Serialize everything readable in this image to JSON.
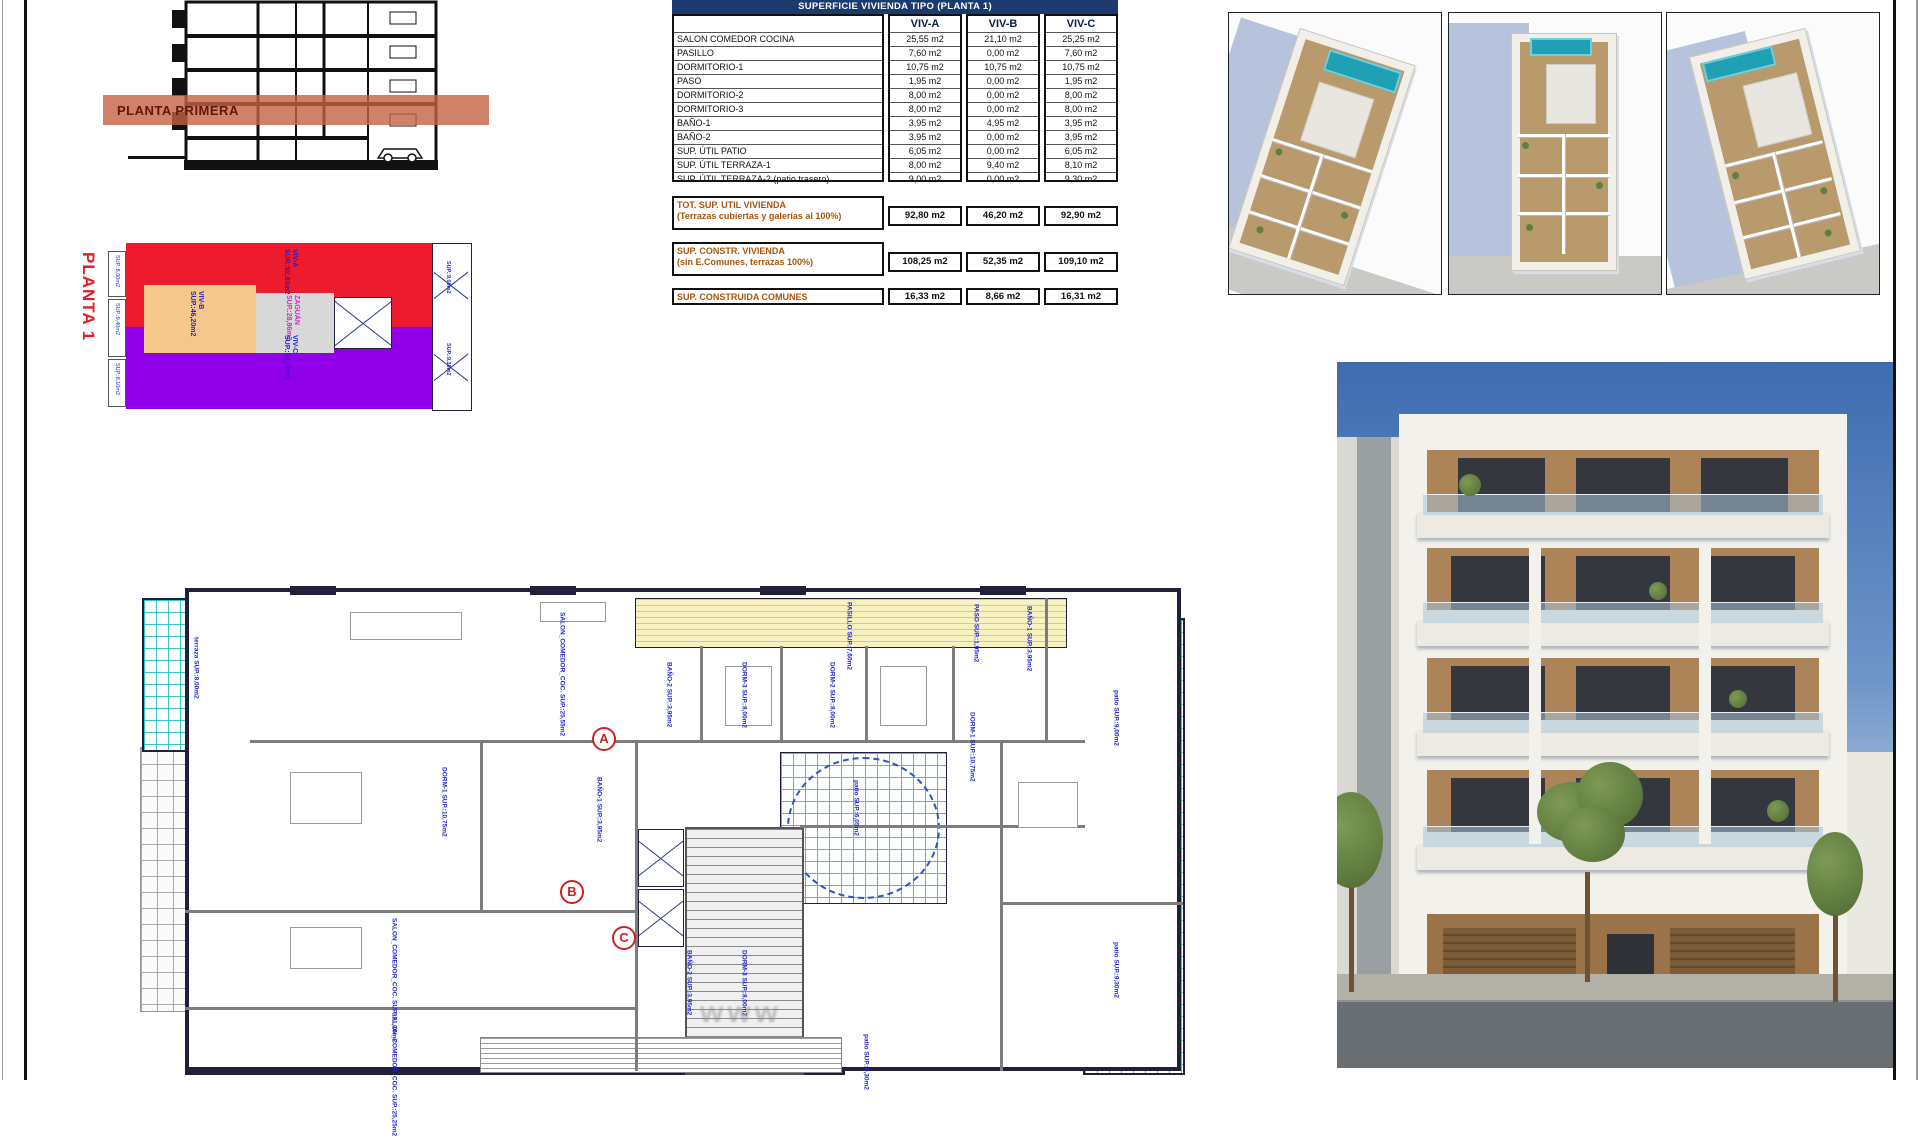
{
  "section_view": {
    "band_label": "PLANTA PRIMERA"
  },
  "key_plan": {
    "title": "PLANTA 1",
    "zones": {
      "viv_a": {
        "name": "VIV-A",
        "area": "SUP.:92,80m2",
        "color": "#ec1b2e"
      },
      "viv_b": {
        "name": "VIV-B",
        "area": "SUP.:46,20m2",
        "color": "#f6c78a"
      },
      "viv_c": {
        "name": "VIV-C",
        "area": "SUP.:92,90m2",
        "color": "#8f00e8"
      },
      "zaguan": {
        "name": "ZAGUÁN",
        "area": "SUP.:28,86m2",
        "color": "#d8d8d8"
      }
    },
    "edge_labels": [
      "SUP.:8,00m2",
      "SUP.:9,40m2",
      "SUP.:8,10m2",
      "SUP.:9,00m2",
      "SUP.:9,30m2"
    ]
  },
  "area_table": {
    "title": "SUPERFICIE VIVIENDA TIPO  (PLANTA 1)",
    "columns": [
      "VIV-A",
      "VIV-B",
      "VIV-C"
    ],
    "rows": [
      {
        "label": "SALON COMEDOR COCINA",
        "values": [
          "25,55 m2",
          "21,10 m2",
          "25,25 m2"
        ]
      },
      {
        "label": "PASILLO",
        "values": [
          "7,60 m2",
          "0,00 m2",
          "7,60 m2"
        ]
      },
      {
        "label": "DORMITORIO-1",
        "values": [
          "10,75 m2",
          "10,75 m2",
          "10,75 m2"
        ]
      },
      {
        "label": "PASO",
        "values": [
          "1,95 m2",
          "0,00 m2",
          "1,95 m2"
        ]
      },
      {
        "label": "DORMITORIO-2",
        "values": [
          "8,00 m2",
          "0,00 m2",
          "8,00 m2"
        ]
      },
      {
        "label": "DORMITORIO-3",
        "values": [
          "8,00 m2",
          "0,00 m2",
          "8,00 m2"
        ]
      },
      {
        "label": "BAÑO-1",
        "values": [
          "3,95 m2",
          "4,95 m2",
          "3,95 m2"
        ]
      },
      {
        "label": "BAÑO-2",
        "values": [
          "3,95 m2",
          "0,00 m2",
          "3,95 m2"
        ]
      },
      {
        "label": "SUP. ÚTIL PATIO",
        "values": [
          "6,05 m2",
          "0,00 m2",
          "6,05 m2"
        ]
      },
      {
        "label": "SUP. ÚTIL TERRAZA-1",
        "values": [
          "8,00 m2",
          "9,40 m2",
          "8,10 m2"
        ]
      },
      {
        "label": "SUP. ÚTIL TERRAZA-2 (patio trasero)",
        "values": [
          "9,00 m2",
          "0,00 m2",
          "9,30 m2"
        ]
      }
    ],
    "totals": [
      {
        "line1": "TOT. SUP. UTIL VIVIENDA",
        "line2": "(Terrazas cubiertas y galerías al 100%)",
        "values": [
          "92,80 m2",
          "46,20 m2",
          "92,90 m2"
        ]
      },
      {
        "line1": "SUP. CONSTR. VIVIENDA",
        "line2": "(sin E.Comunes, terrazas 100%)",
        "values": [
          "108,25 m2",
          "52,35 m2",
          "109,10 m2"
        ]
      },
      {
        "line1": "SUP. CONSTRUIDA COMUNES",
        "line2": "",
        "values": [
          "16,33 m2",
          "8,66 m2",
          "16,31 m2"
        ]
      }
    ]
  },
  "floor_plan": {
    "unit_markers": [
      "A",
      "B",
      "C"
    ],
    "labels": {
      "terraza_a": "terraza SUP.:8,00m2",
      "salon_a": "SALON_COMEDOR_COC. SUP.:25,55m2",
      "dorm1_a": "DORM-1 SUP.:10,75m2",
      "bano1_a": "BAÑO-1 SUP.:3,95m2",
      "pasillo": "PASILLO SUP.:7,60m2",
      "bano2": "BAÑO-2 SUP.:3,95m2",
      "dorm3": "DORM-3 SUP.:8,00m2",
      "dorm2": "DORM-2 SUP.:8,00m2",
      "paso": "PASO SUP.:1,95m2",
      "bano1_c": "BAÑO-1 SUP.:3,95m2",
      "dorm1_c": "DORM-1 SUP.:10,75m2",
      "patio_circle": "patio SUP.:6,05m2",
      "patio_right_top": "patio SUP.:9,00m2",
      "patio_right_bottom": "patio SUP.:9,30m2",
      "salon_b": "SALON_COMEDOR_COC. SUP.:21,10m2",
      "salon_c": "SALON_COMEDOR_COC. SUP.:25,25m2",
      "dorm3_b": "DORM-3 SUP.:8,00m2",
      "bano2_b": "BAÑO-2 SUP.:3,95m2",
      "patio_bottom": "patio SUP.:9,30m2"
    },
    "watermark": "www"
  }
}
